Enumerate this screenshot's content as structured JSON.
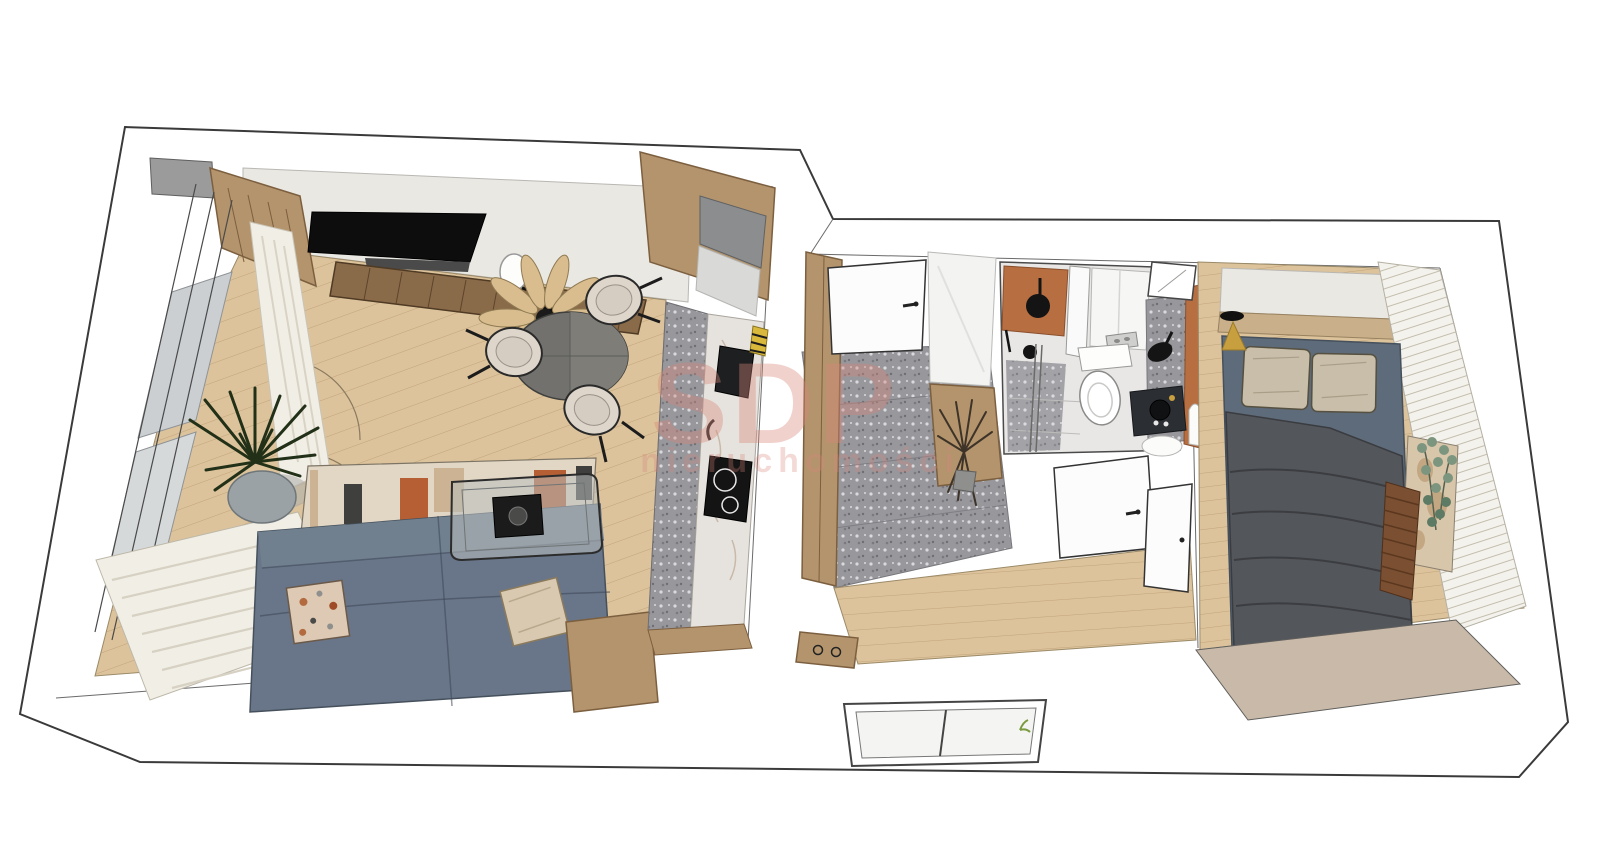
{
  "watermark": {
    "line1": "SDP",
    "line2": "nieruchomości"
  },
  "palette": {
    "bg": "#ffffff",
    "wallWhite": "#ffffff",
    "line": "#3a3a3a",
    "woodFloor": "#dcc39c",
    "plankLine": "#c2a378",
    "marble": "#eae8e3",
    "woodCab": "#b3946d",
    "woodCabLine": "#7c5f3f",
    "consoleWood": "#8a6b49",
    "terrazzo": "#97979c",
    "terrazzoDotLight": "#d9d9de",
    "terrazzoDotDark": "#6e6e73",
    "sofaBlue": "#697689",
    "sofaLine": "#45505c",
    "rugBase": "#e2d7c5",
    "rugOrange": "#b65f35",
    "cream": "#ded6cb",
    "duvet": "#53565b",
    "sheet": "#5e6b7a",
    "pillowBeige": "#c9bea9",
    "terracotta": "#b76f42",
    "black": "#141414",
    "doorWhite": "#fcfcfc",
    "glassGray": "#cbcfd2",
    "curtain": "#f1eee6",
    "gold": "#c79f3f",
    "blindBase": "#f4f2ec",
    "blindLine": "#c3beae",
    "plantDark": "#223018",
    "eucalyptus": "#7c957f",
    "benchBrown": "#7b4f31",
    "tanWall": "#c9b9a8",
    "watermark": "#d8867a"
  },
  "scene": {
    "type": "3d-floorplan-render",
    "view": "axonometric top-down",
    "rooms": [
      {
        "name": "living-room",
        "items": [
          "wall-tv",
          "tv-console",
          "wall-shelves",
          "balcony-windows",
          "curtains",
          "potted-plant",
          "floor-lamp",
          "pendant-light",
          "round-dining-table",
          "dining-chairs-x3",
          "corner-sofa",
          "patchwork-rug",
          "glass-coffee-table",
          "side-table"
        ]
      },
      {
        "name": "kitchen",
        "items": [
          "tall-wood-cabinets",
          "refrigerator",
          "stone-countertop",
          "sink",
          "cooktop",
          "terrazzo-floor-strip",
          "striped-towel"
        ]
      },
      {
        "name": "hallway",
        "items": [
          "entry-door",
          "wood-wardrobe",
          "white-cabinet",
          "wood-sideboard",
          "dried-flowers",
          "terrazzo-floor",
          "wood-floor",
          "shoe-bench",
          "exterior-window"
        ]
      },
      {
        "name": "bathroom",
        "items": [
          "walk-in-shower",
          "rain-shower-head",
          "terracotta-wall",
          "glass-partition",
          "toilet",
          "flush-plate",
          "white-cabinet",
          "terrazzo-countertop",
          "vessel-sink",
          "dark-vanity",
          "arch-mirror",
          "window"
        ]
      },
      {
        "name": "bedroom",
        "items": [
          "double-bed",
          "pillows-x2",
          "dark-duvet",
          "bedside-lamp",
          "headboard-shelf",
          "vertical-blinds",
          "art-panel",
          "eucalyptus-plant",
          "slatted-bench",
          "door"
        ]
      }
    ]
  }
}
